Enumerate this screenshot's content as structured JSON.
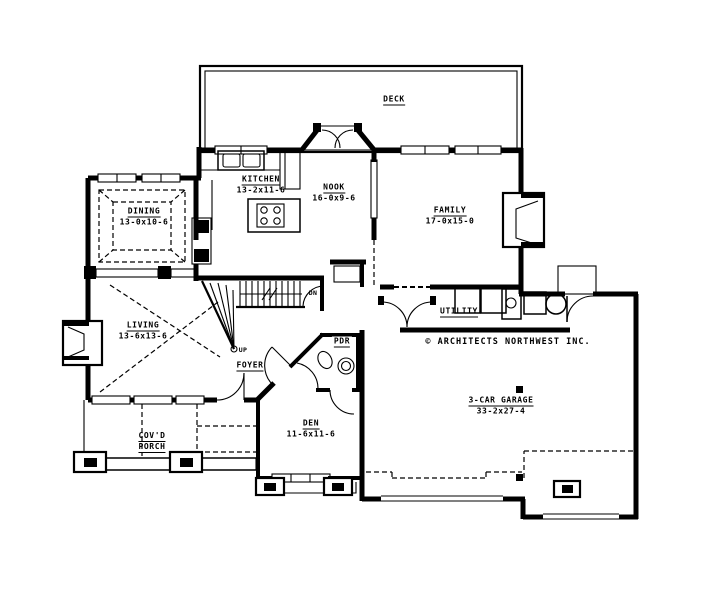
{
  "plan": {
    "deck": {
      "name": "DECK"
    },
    "kitchen": {
      "name": "KITCHEN",
      "dims": "13-2x11-6"
    },
    "nook": {
      "name": "NOOK",
      "dims": "16-0x9-6"
    },
    "family": {
      "name": "FAMILY",
      "dims": "17-0x15-0"
    },
    "dining": {
      "name": "DINING",
      "dims": "13-0x10-6"
    },
    "living": {
      "name": "LIVING",
      "dims": "13-6x13-6"
    },
    "utility": {
      "name": "UTILITY"
    },
    "pdr": {
      "name": "PDR"
    },
    "foyer": {
      "name": "FOYER"
    },
    "den": {
      "name": "DEN",
      "dims": "11-6x11-6"
    },
    "porch": {
      "name_line1": "COV'D",
      "name_line2": "PORCH"
    },
    "garage": {
      "name": "3-CAR GARAGE",
      "dims": "33-2x27-4"
    },
    "stairs": {
      "down": "DN",
      "up": "UP"
    },
    "copyright": "© ARCHITECTS NORTHWEST INC.",
    "colors": {
      "ink": "#000000",
      "paper": "#ffffff"
    }
  }
}
